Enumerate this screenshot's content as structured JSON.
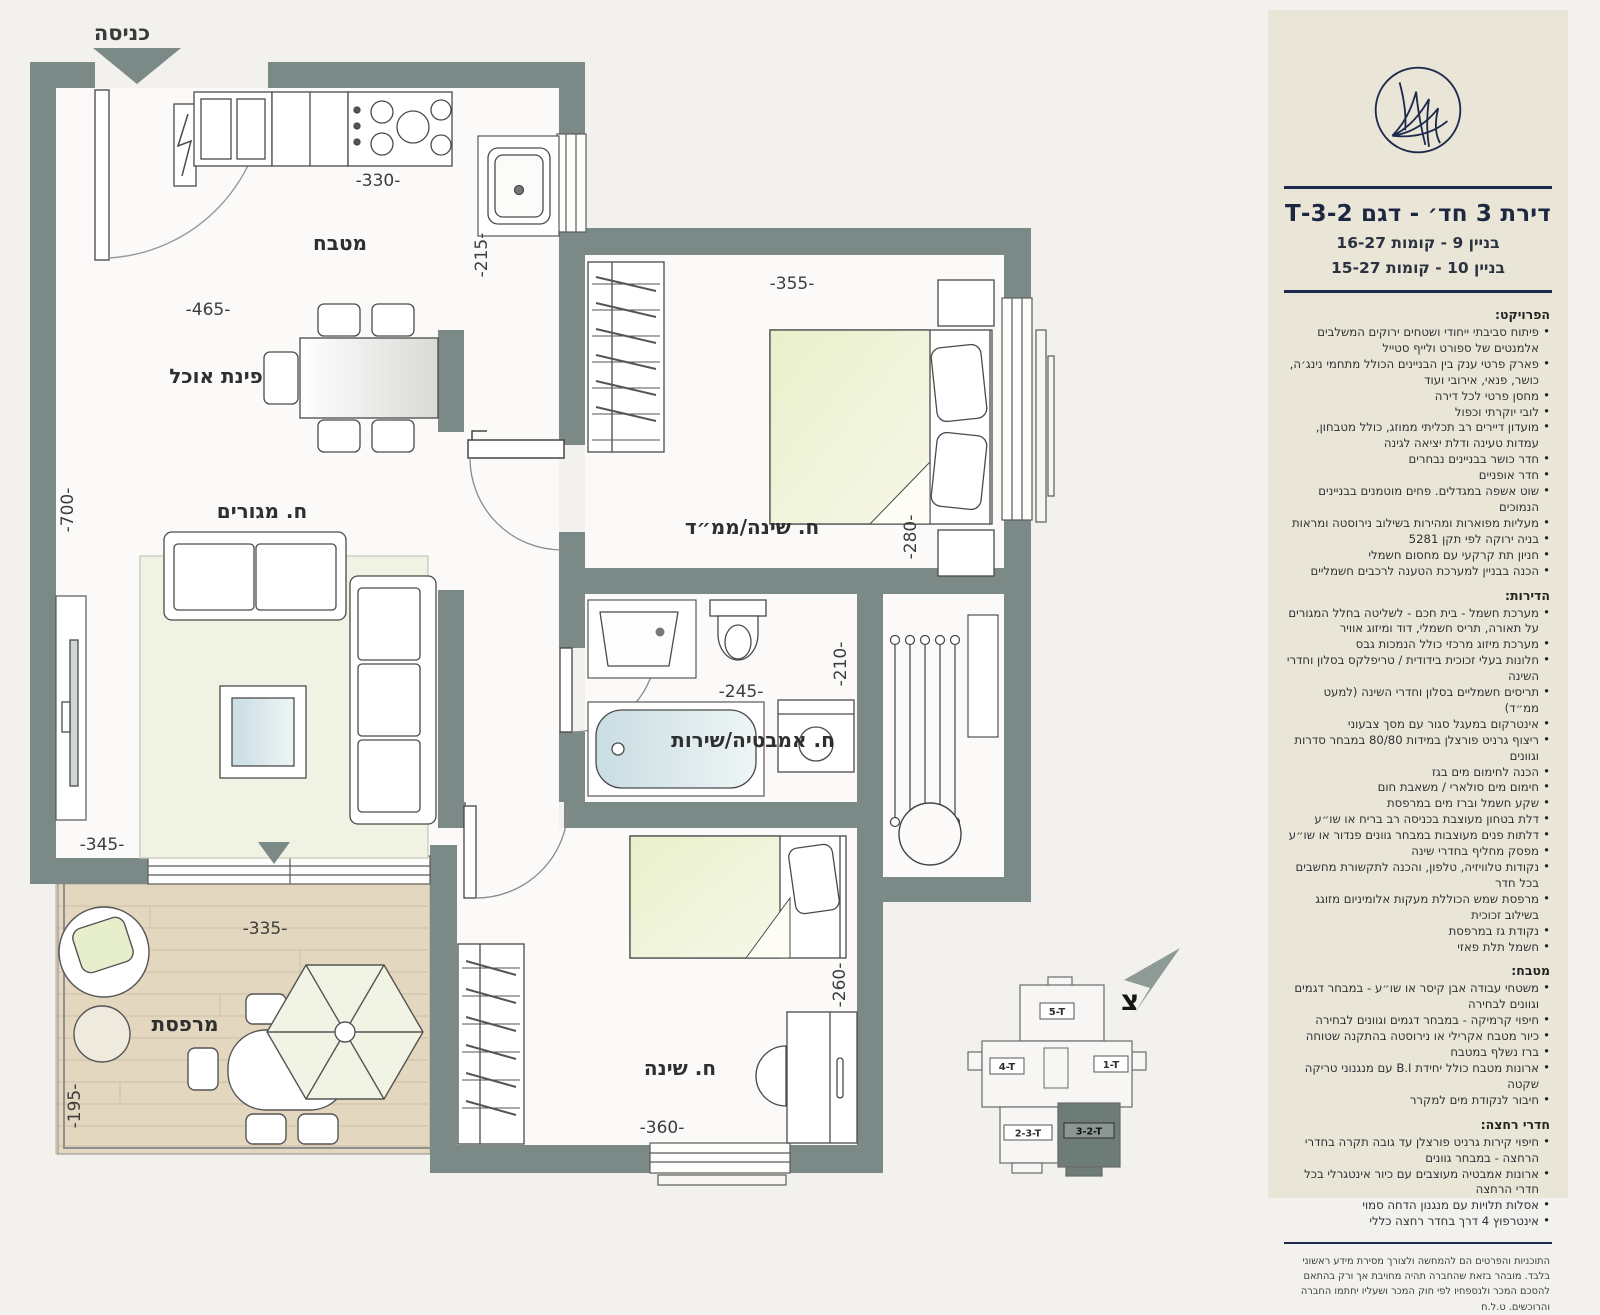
{
  "page": {
    "background": "#f2f1ee"
  },
  "colors": {
    "wall": "#7b8a87",
    "accent_navy": "#1e2a4d",
    "panel_bg": "#eae6d7",
    "deck_wood": "#e3d7bf"
  },
  "plan": {
    "entrance_label": "כניסה",
    "rooms": {
      "kitchen": "מטבח",
      "dining": "פינת אוכל",
      "living": "ח. מגורים",
      "master_bedroom": "ח. שינה/ממ״ד",
      "bathroom": "ח. אמבטיה/שירות",
      "bedroom": "ח. שינה",
      "balcony": "מרפסת"
    },
    "dimensions": {
      "kitchen_top": "-330-",
      "kitchen_side": "-215-",
      "dining_width": "-465-",
      "living_height": "-700-",
      "living_width": "-345-",
      "master_width": "-355-",
      "master_depth": "-280-",
      "bathroom_width": "-245-",
      "bathroom_depth": "-210-",
      "bedroom_width": "-360-",
      "bedroom_depth": "-260-",
      "balcony_width": "-335-",
      "balcony_depth": "-195-"
    },
    "north_label": "צ",
    "keyplan": {
      "unit_top": "5-T",
      "unit_left": "4-T",
      "unit_right": "1-T",
      "unit_bottom_left": "2-3-T",
      "unit_bottom_right": "3-2-T"
    }
  },
  "sidebar": {
    "title": "דירת 3 חד׳ - דגם 3-2-T",
    "building_line1": "בניין 9  - קומות 16-27",
    "building_line2": "בניין 10 - קומות 15-27",
    "sections": [
      {
        "heading": "הפרויקט:",
        "bullets": [
          "פיתוח סביבתי ייחודי ושטחים ירוקים המשלבים אלמנטים של ספורט ולייף סטייל",
          "פארק פרטי ענק בין הבניינים הכולל מתחמי נינג׳ה, כושר, פנאי, אירובי ועוד",
          "מחסן פרטי לכל דירה",
          "לובי יוקרתי וכפול",
          "מועדון דיירים רב תכליתי ממוזג, כולל מטבחון, עמדות טעינה ודלת יציאה לגינה",
          "חדר כושר בבניינים נבחרים",
          "חדר אופניים",
          "שוט אשפה במגדלים. פחים מוטמנים בבניינים הנמוכים",
          "מעליות מפוארות ומהירות בשילוב נירוסטה ומראות",
          "בניה ירוקה לפי תקן 5281",
          "חניון תת קרקעי עם מחסום חשמלי",
          "הכנה בבניין למערכת הטענה לרכבים חשמליים"
        ]
      },
      {
        "heading": "הדירות:",
        "bullets": [
          "מערכת חשמל - בית חכם - לשליטה בחלל המגורים על תאורה, תריס חשמלי, דוד ומיזוג אוויר",
          "מערכת מיזוג מרכזי כולל הנמכות גבס",
          "חלונות בעלי זכוכית בידודית / טריפלקס בסלון וחדרי השינה",
          "תריסים חשמליים בסלון וחדרי השינה (למעט ממ״ד)",
          "אינטרקום במעגל סגור עם מסך צבעוני",
          "ריצוף גרניט פורצלן במידות 80/80 במבחר סדרות וגוונים",
          "הכנה לחימום מים בגז",
          "חימום מים סולארי / משאבת חום",
          "שקע חשמל וברז מים במרפסת",
          "דלת בטחון מעוצבת בכניסה רב בריח או שו״ע",
          "דלתות פנים מעוצבות במבחר גוונים פנדור או שו״ע",
          "מפסק מחליף בחדרי שינה",
          "נקודות טלוויזיה, טלפון, והכנה לתקשורת מחשבים בכל חדר",
          "מרפסת שמש הכוללת מעקות אלומיניום מזוגג בשילוב זכוכית",
          "נקודת גז במרפסת",
          "חשמל תלת פאזי"
        ]
      },
      {
        "heading": "מטבח:",
        "bullets": [
          "משטחי עבודה אבן קיסר או שו״ע - במבחר דגמים וגוונים לבחירה",
          "חיפוי קרמיקה - במבחר דגמים וגוונים לבחירה",
          "כיור מטבח אקרילי או נירוסטה בהתקנה שטוחה",
          "ברז נשלף במטבח",
          "ארונות מטבח כולל יחידת B.I עם מנגנוני טריקה שקטה",
          "חיבור לנקודת מים למקרר"
        ]
      },
      {
        "heading": "חדרי רחצה:",
        "bullets": [
          "חיפוי קירות גרניט פורצלן עד גובה תקרה בחדרי הרחצה - במבחר גוונים",
          "ארונות אמבטיה מעוצבים עם כיור אינטגרלי בכל חדרי הרחצה",
          "אסלות תלויות עם מנגנון הדחה סמוי",
          "אינטרפוץ 4 דרך בחדר רחצה כללי"
        ]
      }
    ],
    "footer": "התוכניות והפרטים הם להמחשה ולצורך מסירת מידע ראשוני בלבד. מובהר בזאת שהחברה תהיה מחויבת אך ורק בהתאם להסכם המכר ולנספחיו לפי חוק המכר ושעליו יחתמו החברה והרוכשים. ט.ל.ח"
  }
}
